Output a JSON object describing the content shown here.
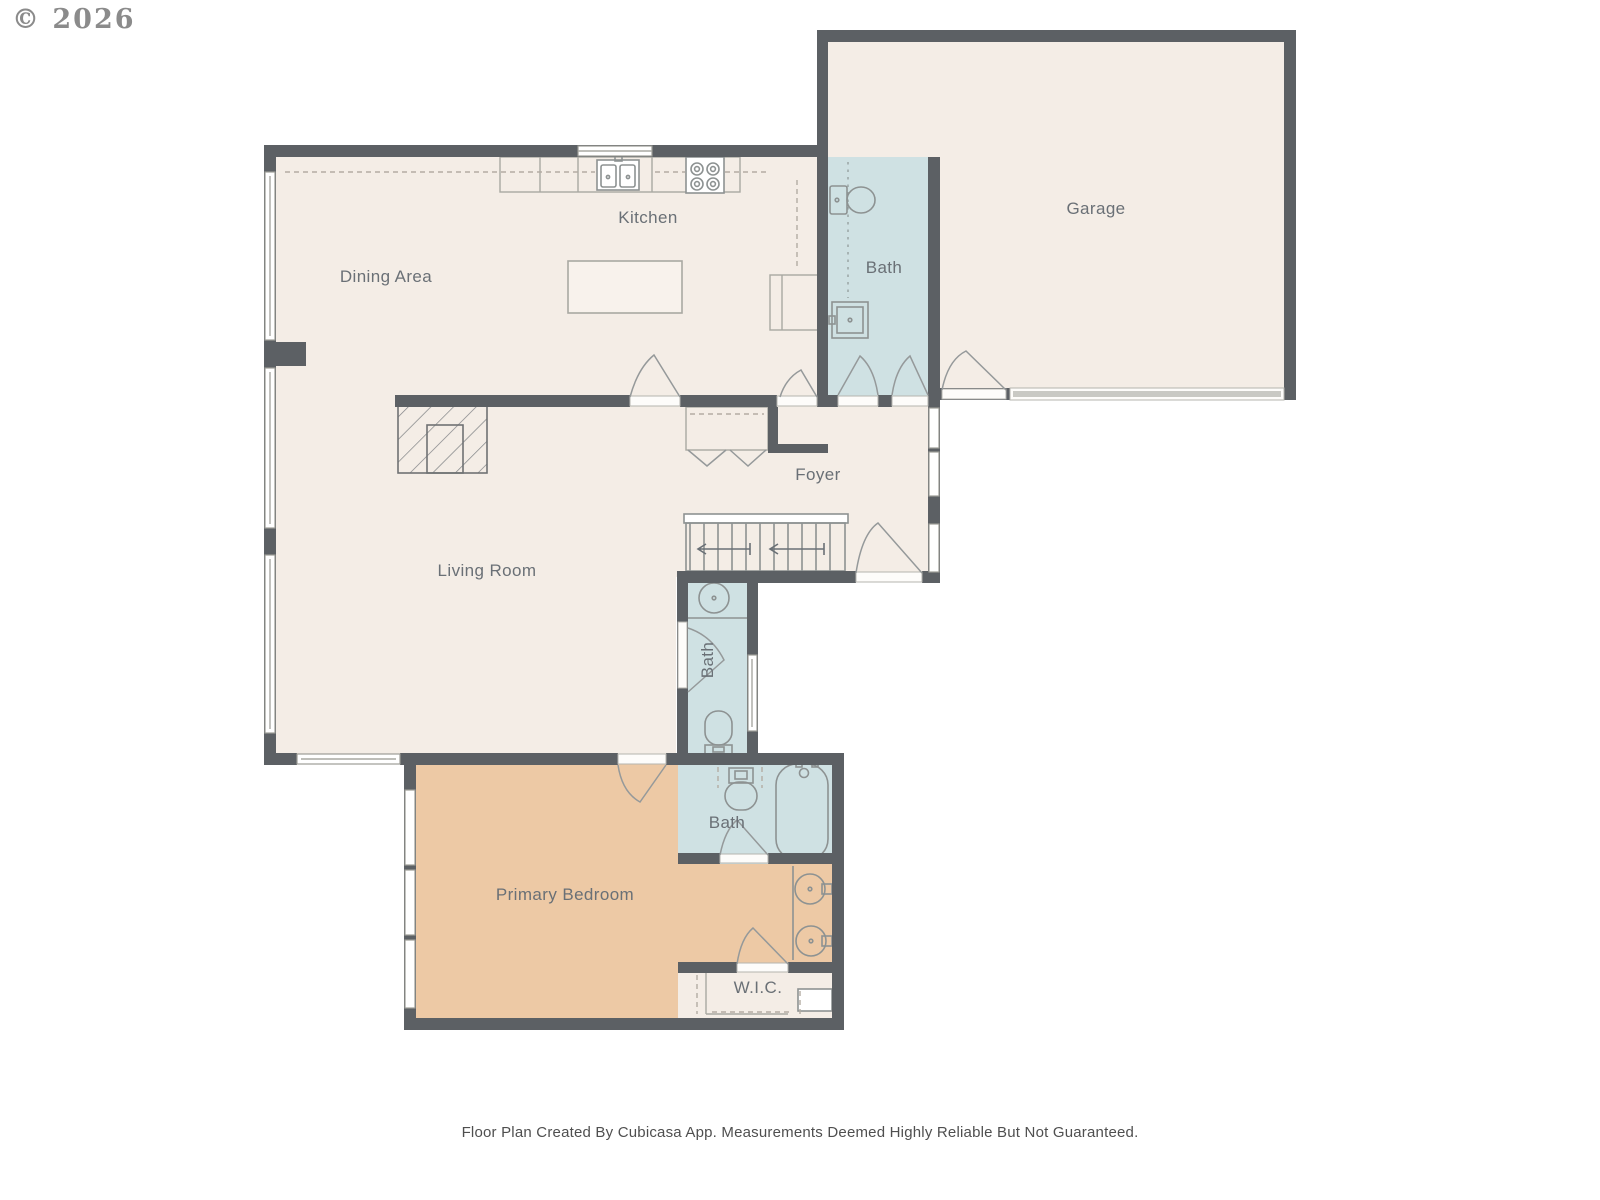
{
  "copyright": "© 2026",
  "footer": "Floor Plan Created By Cubicasa App. Measurements Deemed Highly Reliable But Not Guaranteed.",
  "rooms": {
    "kitchen": {
      "label": "Kitchen"
    },
    "dining": {
      "label": "Dining Area"
    },
    "garage": {
      "label": "Garage"
    },
    "bath_upper": {
      "label": "Bath"
    },
    "foyer": {
      "label": "Foyer"
    },
    "living": {
      "label": "Living Room"
    },
    "bath_middle": {
      "label": "Bath"
    },
    "bath_primary": {
      "label": "Bath"
    },
    "primary_bedroom": {
      "label": "Primary Bedroom"
    },
    "wic": {
      "label": "W.I.C."
    }
  },
  "colors": {
    "wall": "#5c6064",
    "floor": "#f4ede6",
    "bath_floor": "#cfe1e3",
    "bedroom_floor": "#edc9a5",
    "label_text": "#6a7076",
    "fixture_line": "#8d9292",
    "garage_door_band": "#c9c9c4",
    "background": "#ffffff"
  },
  "fixtures": [
    "toilet",
    "bathroom-sink",
    "double-kitchen-sink",
    "stove-4-burner",
    "kitchen-island",
    "refrigerator",
    "fireplace",
    "bathtub",
    "vanity-sink",
    "vanity-sink",
    "staircase",
    "closet-bifold-doors",
    "garage-door"
  ]
}
